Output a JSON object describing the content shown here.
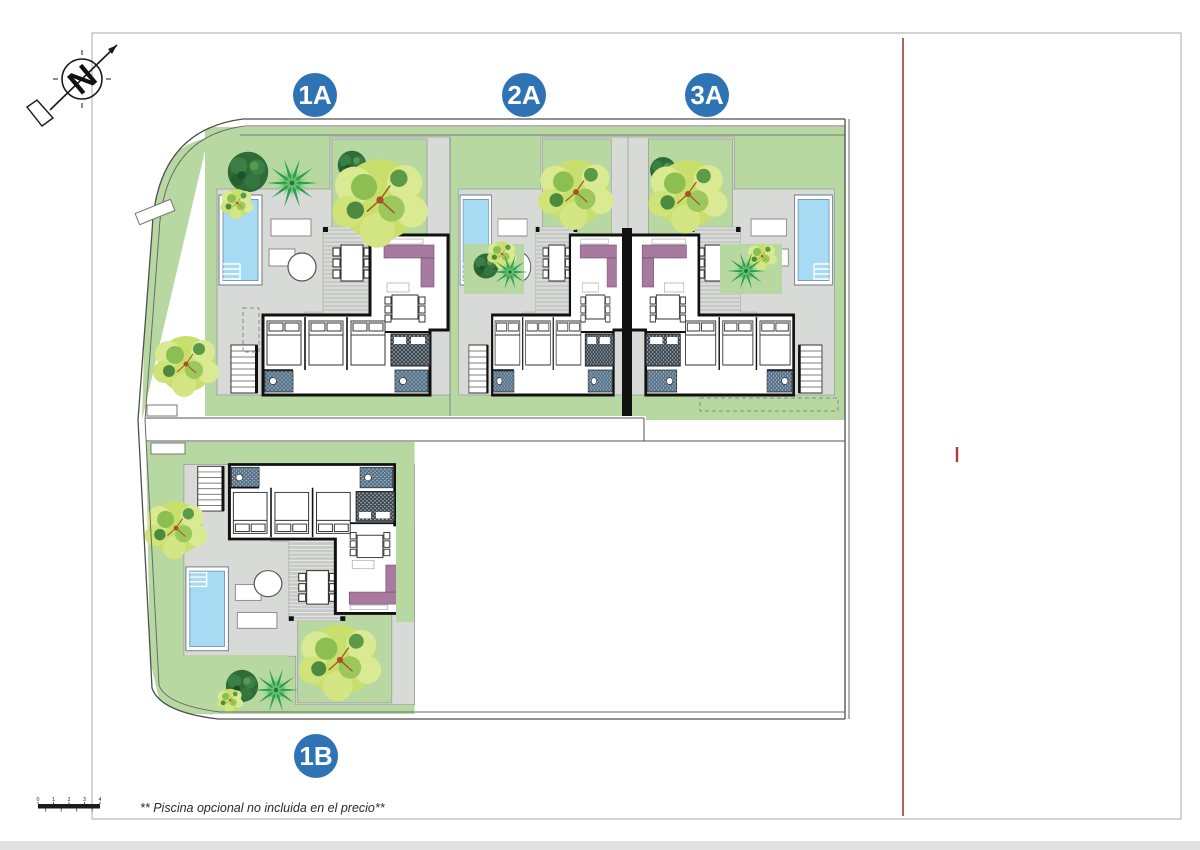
{
  "plots": [
    {
      "label": "1A"
    },
    {
      "label": "2A"
    },
    {
      "label": "3A"
    },
    {
      "label": "1B"
    }
  ],
  "compass": {
    "letter": "N"
  },
  "footnote": "** Piscina opcional no incluida en el precio**",
  "scalebar": {
    "ticks": [
      "0",
      "1",
      "2",
      "3",
      "4"
    ]
  },
  "colors": {
    "label_circle": "#2e74b5",
    "lawn": "#b8d8a2",
    "hardscape": "#d8dad8",
    "pool": "#a7dbf3",
    "tree_yellow": "#c9df6b",
    "tree_dark": "#2e6b38",
    "palm": "#2aa24f",
    "sofa": "#a87a9f",
    "walls": "#111111",
    "reference_line": "#8c1d18"
  }
}
